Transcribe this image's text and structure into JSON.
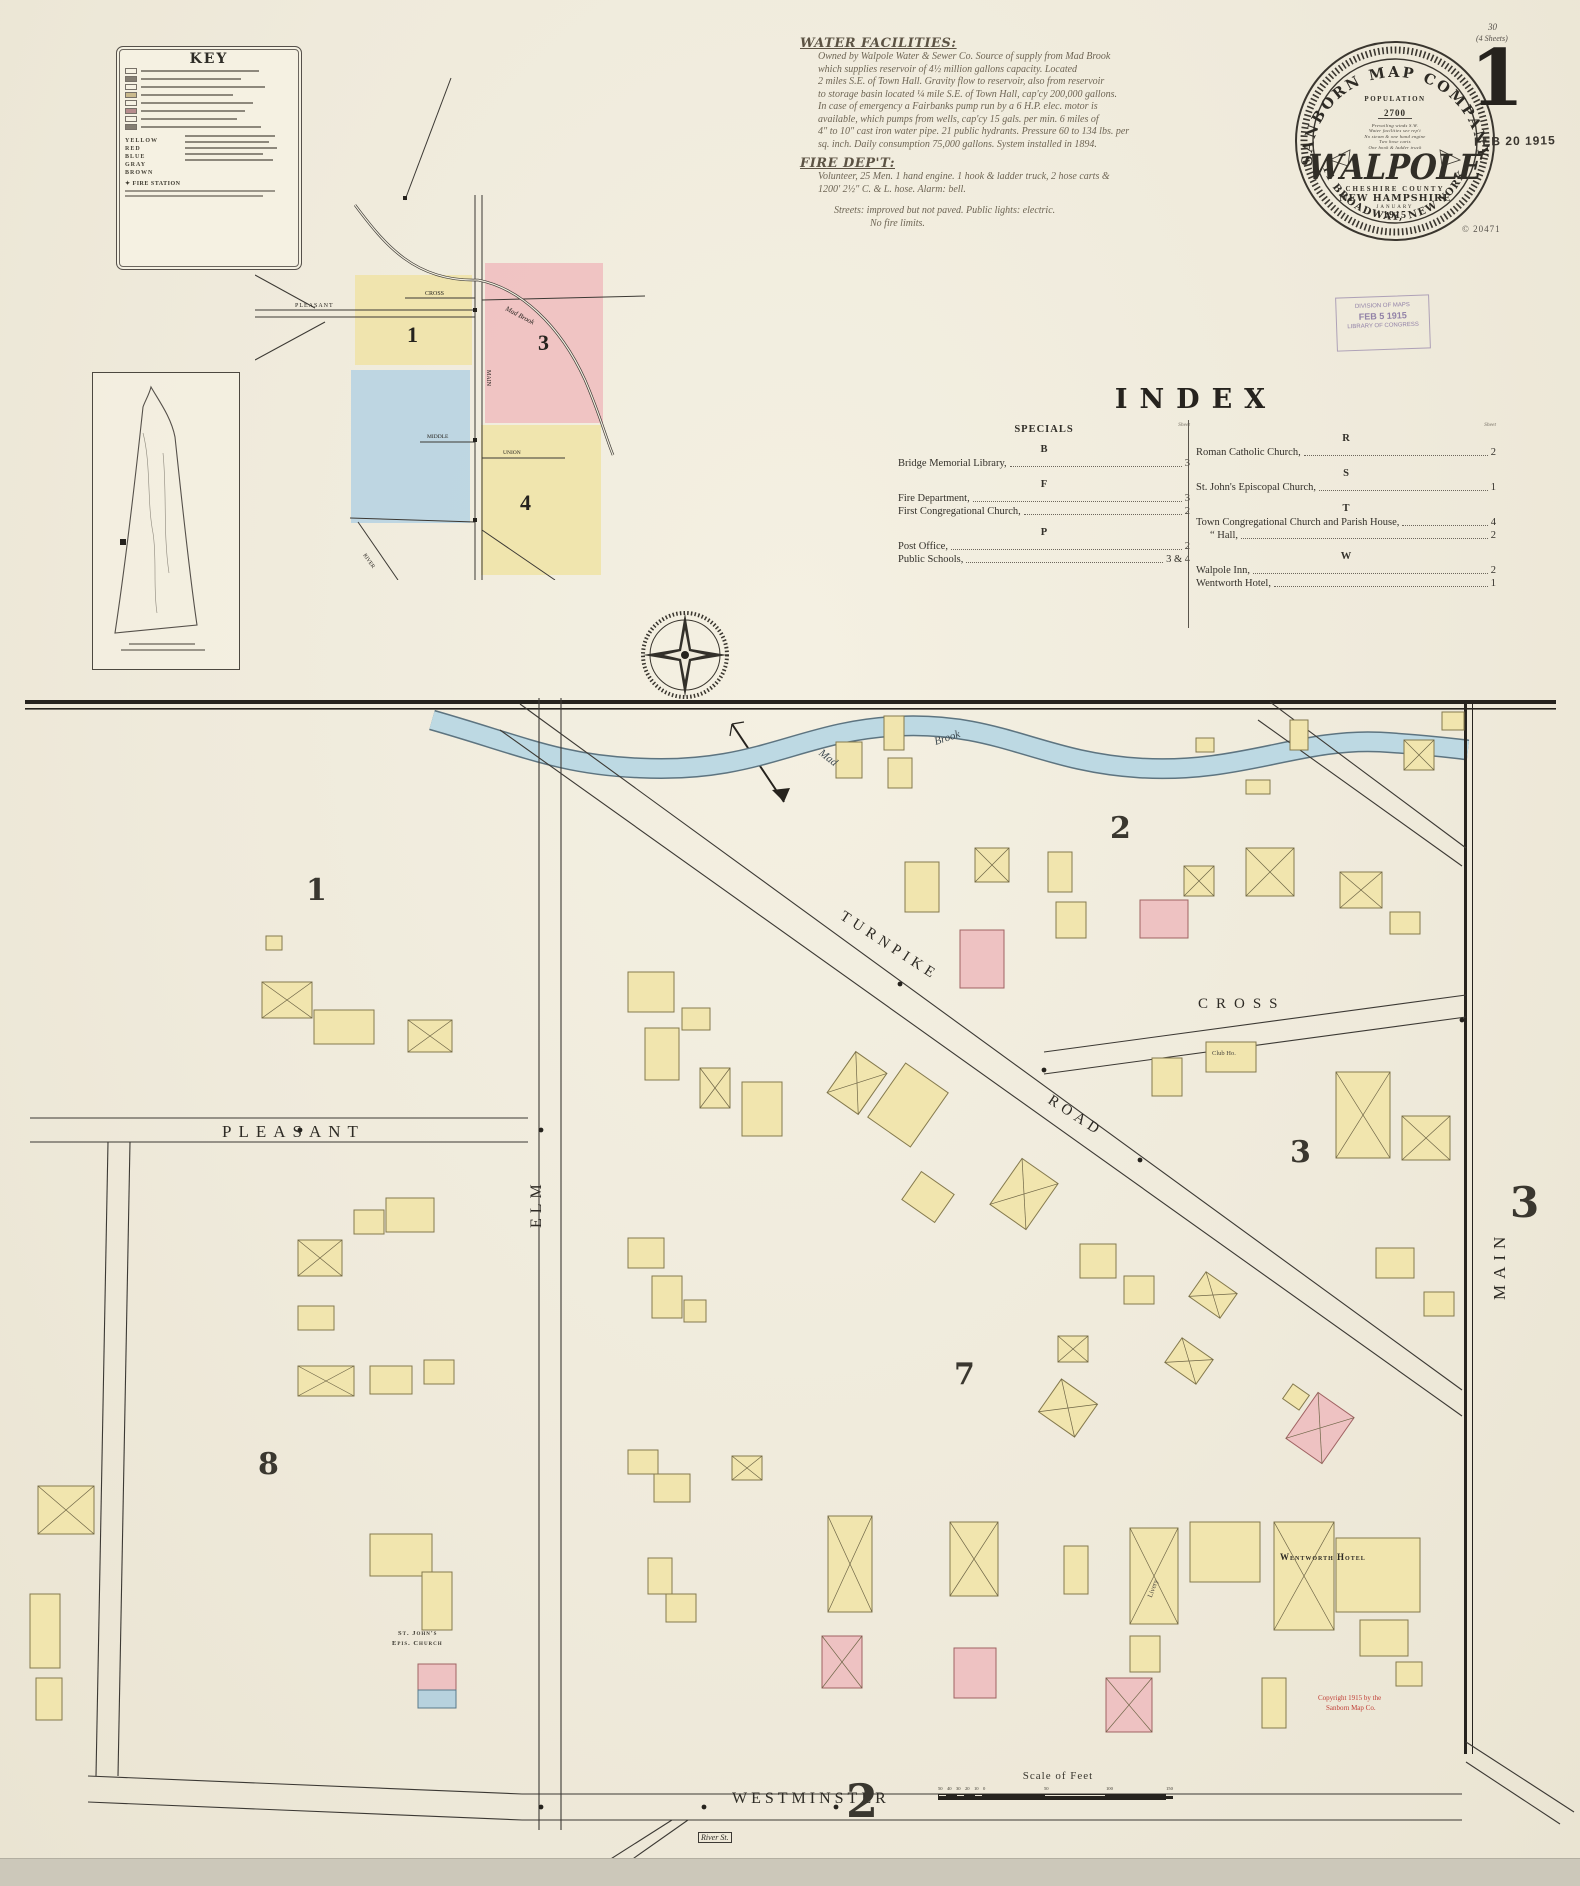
{
  "page": {
    "sheet_small": "30",
    "sheets_note": "(4 Sheets)",
    "sheet_big": "1",
    "date_stamp": "FEB 20 1915",
    "copyright_code": "© 20471",
    "received_stamp": {
      "line1": "DIVISION OF MAPS",
      "line2": "FEB 5 1915",
      "line3": "LIBRARY OF CONGRESS"
    }
  },
  "stamp": {
    "company_arc": "SANBORN MAP COMPANY.",
    "address_arc": "11 BROADWAY, NEW YORK.",
    "population_label": "POPULATION",
    "population_value": "2700",
    "notes": [
      "Prevailing winds S.W.",
      "Water facilities see rep't",
      "No steam & one hand engine",
      "Two hose carts",
      "One hook & ladder truck"
    ],
    "city": "WALPOLE",
    "county": "CHESHIRE COUNTY",
    "state": "NEW HAMPSHIRE",
    "month": "JANUARY",
    "year": "1915"
  },
  "key": {
    "title": "KEY",
    "colors": [
      "YELLOW",
      "RED",
      "BLUE",
      "GRAY",
      "BROWN"
    ],
    "fire_station": "✦ FIRE STATION"
  },
  "water": {
    "title": "WATER FACILITIES:",
    "lines": [
      "Owned by Walpole Water & Sewer Co. Source of supply from Mad Brook",
      "which supplies reservoir of 4½ million gallons capacity. Located",
      "2 miles S.E. of Town Hall. Gravity flow to reservoir, also from reservoir",
      "to storage basin located ¼ mile S.E. of Town Hall, cap'cy 200,000 gallons.",
      "In case of emergency a Fairbanks pump run by a 6 H.P. elec. motor is",
      "available, which pumps from wells, cap'cy 15 gals. per min. 6 miles of",
      "4\" to 10\" cast iron water pipe. 21 public hydrants. Pressure 60 to 134 lbs. per",
      "sq. inch. Daily consumption 75,000 gallons. System installed in 1894."
    ],
    "fire_title": "FIRE DEP'T:",
    "fire_lines": [
      "Volunteer, 25 Men. 1 hand engine. 1 hook & ladder truck, 2 hose carts &",
      "1200' 2½\" C. & L. hose. Alarm: bell."
    ],
    "streets_note": "Streets: improved but not paved. Public lights: electric.",
    "limits_note": "No fire limits."
  },
  "index": {
    "title": "INDEX",
    "sheet_word": "Sheet",
    "left": {
      "heading": "SPECIALS",
      "groups": [
        {
          "letter": "B",
          "entries": [
            {
              "name": "Bridge Memorial Library,",
              "page": "3"
            }
          ]
        },
        {
          "letter": "F",
          "entries": [
            {
              "name": "Fire Department,",
              "page": "3"
            },
            {
              "name": "First Congregational Church,",
              "page": "2"
            }
          ]
        },
        {
          "letter": "P",
          "entries": [
            {
              "name": "Post Office,",
              "page": "2"
            },
            {
              "name": "Public Schools,",
              "page": "3 & 4"
            }
          ]
        }
      ]
    },
    "right": {
      "heading": "",
      "groups": [
        {
          "letter": "R",
          "entries": [
            {
              "name": "Roman Catholic Church,",
              "page": "2"
            }
          ]
        },
        {
          "letter": "S",
          "entries": [
            {
              "name": "St. John's Episcopal Church,",
              "page": "1"
            }
          ]
        },
        {
          "letter": "T",
          "entries": [
            {
              "name": "Town Congregational Church and Parish House,",
              "page": "4"
            },
            {
              "name": "“  Hall,",
              "page": "2",
              "indent": true
            }
          ]
        },
        {
          "letter": "W",
          "entries": [
            {
              "name": "Walpole Inn,",
              "page": "2"
            },
            {
              "name": "Wentworth Hotel,",
              "page": "1"
            }
          ]
        }
      ]
    }
  },
  "inset": {
    "districts": [
      "1",
      "3",
      "4"
    ],
    "streets": [
      "PLEASANT",
      "CROSS",
      "MAIN",
      "MIDDLE",
      "UNION",
      "RIVER"
    ],
    "brook_label": "Mad Brook"
  },
  "map": {
    "brook_label_a": "Mad",
    "brook_label_b": "Brook",
    "streets": {
      "turnpike_a": "TURNPIKE",
      "turnpike_b": "ROAD",
      "cross": "CROSS",
      "pleasant": "PLEASANT",
      "elm": "ELM",
      "main": "MAIN",
      "westminster": "WESTMINSTER",
      "river": "River St."
    },
    "districts": [
      {
        "t": "1",
        "x": 306,
        "y": 876,
        "s": 30
      },
      {
        "t": "2",
        "x": 1110,
        "y": 814,
        "s": 30
      },
      {
        "t": "3",
        "x": 1290,
        "y": 1138,
        "s": 30
      },
      {
        "t": "7",
        "x": 954,
        "y": 1360,
        "s": 30
      },
      {
        "t": "8",
        "x": 258,
        "y": 1450,
        "s": 30
      },
      {
        "t": "3",
        "x": 1510,
        "y": 1182,
        "s": 42
      },
      {
        "t": "2",
        "x": 846,
        "y": 1778,
        "s": 46
      }
    ],
    "landmarks": [
      {
        "t": "Wentworth Hotel",
        "x": 1280,
        "y": 1552,
        "s": 9,
        "b": 1,
        "c": "#2e2b25",
        "r": 0
      },
      {
        "t": "Livery",
        "x": 1146,
        "y": 1596,
        "s": 7,
        "b": 0,
        "c": "#4a463e",
        "r": -70
      },
      {
        "t": "Club Ho.",
        "x": 1212,
        "y": 1050,
        "s": 6.5,
        "b": 0,
        "c": "#4a463e",
        "r": 0
      },
      {
        "t": "St. John's",
        "x": 398,
        "y": 1630,
        "s": 6.5,
        "b": 1,
        "c": "#3a372f",
        "r": 0
      },
      {
        "t": "Epis. Church",
        "x": 392,
        "y": 1640,
        "s": 6.5,
        "b": 1,
        "c": "#3a372f",
        "r": 0
      },
      {
        "t": "Copyright 1915 by the",
        "x": 1318,
        "y": 1694,
        "s": 7,
        "b": 0,
        "c": "#c04038",
        "r": 0
      },
      {
        "t": "Sanborn Map Co.",
        "x": 1326,
        "y": 1704,
        "s": 7,
        "b": 0,
        "c": "#c04038",
        "r": 0
      }
    ],
    "scale": {
      "label": "Scale of Feet",
      "ticks": [
        {
          "t": "50",
          "x": 0
        },
        {
          "t": "40",
          "x": 9
        },
        {
          "t": "30",
          "x": 18
        },
        {
          "t": "20",
          "x": 27
        },
        {
          "t": "10",
          "x": 36
        },
        {
          "t": "0",
          "x": 45
        },
        {
          "t": "50",
          "x": 106
        },
        {
          "t": "100",
          "x": 168
        },
        {
          "t": "150",
          "x": 228
        }
      ]
    },
    "palette": {
      "y": {
        "fill": "#f1e5ae",
        "stroke": "#857a4e"
      },
      "p": {
        "fill": "#eec2c2",
        "stroke": "#a06363"
      },
      "b": {
        "fill": "#b7d2de",
        "stroke": "#5a7a8a"
      }
    },
    "buildings": [
      [
        905,
        862,
        34,
        50,
        0,
        "y",
        0
      ],
      [
        975,
        848,
        34,
        34,
        0,
        "y",
        1
      ],
      [
        960,
        930,
        44,
        58,
        0,
        "p",
        0
      ],
      [
        1048,
        852,
        24,
        40,
        0,
        "y",
        0
      ],
      [
        1056,
        902,
        30,
        36,
        0,
        "y",
        0
      ],
      [
        1140,
        900,
        48,
        38,
        0,
        "p",
        0
      ],
      [
        1184,
        866,
        30,
        30,
        0,
        "y",
        1
      ],
      [
        1246,
        848,
        48,
        48,
        0,
        "y",
        1
      ],
      [
        1340,
        872,
        42,
        36,
        0,
        "y",
        1
      ],
      [
        1390,
        912,
        30,
        22,
        0,
        "y",
        0
      ],
      [
        1196,
        738,
        18,
        14,
        0,
        "y",
        0
      ],
      [
        1246,
        780,
        24,
        14,
        0,
        "y",
        0
      ],
      [
        1290,
        720,
        18,
        30,
        0,
        "y",
        0
      ],
      [
        1404,
        740,
        30,
        30,
        0,
        "y",
        1
      ],
      [
        1442,
        712,
        22,
        18,
        0,
        "y",
        0
      ],
      [
        836,
        742,
        26,
        36,
        0,
        "y",
        0
      ],
      [
        884,
        716,
        20,
        34,
        0,
        "y",
        0
      ],
      [
        888,
        758,
        24,
        30,
        0,
        "y",
        0
      ],
      [
        838,
        1058,
        38,
        50,
        35,
        "y",
        1
      ],
      [
        882,
        1072,
        52,
        66,
        35,
        "y",
        0
      ],
      [
        908,
        1180,
        40,
        34,
        35,
        "y",
        0
      ],
      [
        1002,
        1166,
        44,
        56,
        35,
        "y",
        1
      ],
      [
        1080,
        1244,
        36,
        34,
        0,
        "y",
        0
      ],
      [
        1124,
        1276,
        30,
        28,
        0,
        "y",
        0
      ],
      [
        1194,
        1280,
        38,
        30,
        35,
        "y",
        1
      ],
      [
        1058,
        1336,
        30,
        26,
        0,
        "y",
        1
      ],
      [
        1170,
        1346,
        38,
        30,
        35,
        "y",
        1
      ],
      [
        700,
        1068,
        30,
        40,
        0,
        "y",
        1
      ],
      [
        742,
        1082,
        40,
        54,
        0,
        "y",
        0
      ],
      [
        628,
        1238,
        36,
        30,
        0,
        "y",
        0
      ],
      [
        652,
        1276,
        30,
        42,
        0,
        "y",
        0
      ],
      [
        684,
        1300,
        22,
        22,
        0,
        "y",
        0
      ],
      [
        628,
        1450,
        30,
        24,
        0,
        "y",
        0
      ],
      [
        654,
        1474,
        36,
        28,
        0,
        "y",
        0
      ],
      [
        732,
        1456,
        30,
        24,
        0,
        "y",
        1
      ],
      [
        648,
        1558,
        24,
        36,
        0,
        "y",
        0
      ],
      [
        666,
        1594,
        30,
        28,
        0,
        "y",
        0
      ],
      [
        1152,
        1058,
        30,
        38,
        0,
        "y",
        0
      ],
      [
        1206,
        1042,
        50,
        30,
        0,
        "y",
        0
      ],
      [
        1336,
        1072,
        54,
        86,
        0,
        "y",
        1
      ],
      [
        1402,
        1116,
        48,
        44,
        0,
        "y",
        1
      ],
      [
        1376,
        1248,
        38,
        30,
        0,
        "y",
        0
      ],
      [
        1424,
        1292,
        30,
        24,
        0,
        "y",
        0
      ],
      [
        262,
        982,
        50,
        36,
        0,
        "y",
        1
      ],
      [
        266,
        936,
        16,
        14,
        0,
        "y",
        0
      ],
      [
        314,
        1010,
        60,
        34,
        0,
        "y",
        0
      ],
      [
        408,
        1020,
        44,
        32,
        0,
        "y",
        1
      ],
      [
        628,
        972,
        46,
        40,
        0,
        "y",
        0
      ],
      [
        645,
        1028,
        34,
        52,
        0,
        "y",
        0
      ],
      [
        682,
        1008,
        28,
        22,
        0,
        "y",
        0
      ],
      [
        298,
        1240,
        44,
        36,
        0,
        "y",
        1
      ],
      [
        354,
        1210,
        30,
        24,
        0,
        "y",
        0
      ],
      [
        386,
        1198,
        48,
        34,
        0,
        "y",
        0
      ],
      [
        298,
        1306,
        36,
        24,
        0,
        "y",
        0
      ],
      [
        298,
        1366,
        56,
        30,
        0,
        "y",
        1
      ],
      [
        370,
        1366,
        42,
        28,
        0,
        "y",
        0
      ],
      [
        424,
        1360,
        30,
        24,
        0,
        "y",
        0
      ],
      [
        38,
        1486,
        56,
        48,
        0,
        "y",
        1
      ],
      [
        30,
        1594,
        30,
        74,
        0,
        "y",
        0
      ],
      [
        36,
        1678,
        26,
        42,
        0,
        "y",
        0
      ],
      [
        370,
        1534,
        62,
        42,
        0,
        "y",
        0
      ],
      [
        422,
        1572,
        30,
        58,
        0,
        "y",
        0
      ],
      [
        418,
        1664,
        38,
        26,
        0,
        "p",
        0
      ],
      [
        418,
        1690,
        38,
        18,
        0,
        "b",
        0
      ],
      [
        828,
        1516,
        44,
        96,
        0,
        "y",
        1
      ],
      [
        822,
        1636,
        40,
        52,
        0,
        "p",
        1
      ],
      [
        950,
        1522,
        48,
        74,
        0,
        "y",
        1
      ],
      [
        954,
        1648,
        42,
        50,
        0,
        "p",
        0
      ],
      [
        1064,
        1546,
        24,
        48,
        0,
        "y",
        0
      ],
      [
        1106,
        1678,
        46,
        54,
        0,
        "p",
        1
      ],
      [
        1130,
        1636,
        30,
        36,
        0,
        "y",
        0
      ],
      [
        1262,
        1678,
        24,
        50,
        0,
        "y",
        0
      ],
      [
        1130,
        1528,
        48,
        96,
        0,
        "y",
        1
      ],
      [
        1190,
        1522,
        70,
        60,
        0,
        "y",
        0
      ],
      [
        1274,
        1522,
        60,
        108,
        0,
        "y",
        1
      ],
      [
        1336,
        1538,
        84,
        74,
        0,
        "y",
        0
      ],
      [
        1360,
        1620,
        48,
        36,
        0,
        "y",
        0
      ],
      [
        1396,
        1662,
        26,
        24,
        0,
        "y",
        0
      ],
      [
        1298,
        1400,
        44,
        56,
        35,
        "p",
        1
      ],
      [
        1286,
        1388,
        20,
        18,
        35,
        "y",
        0
      ],
      [
        1046,
        1388,
        44,
        40,
        35,
        "y",
        1
      ]
    ]
  }
}
